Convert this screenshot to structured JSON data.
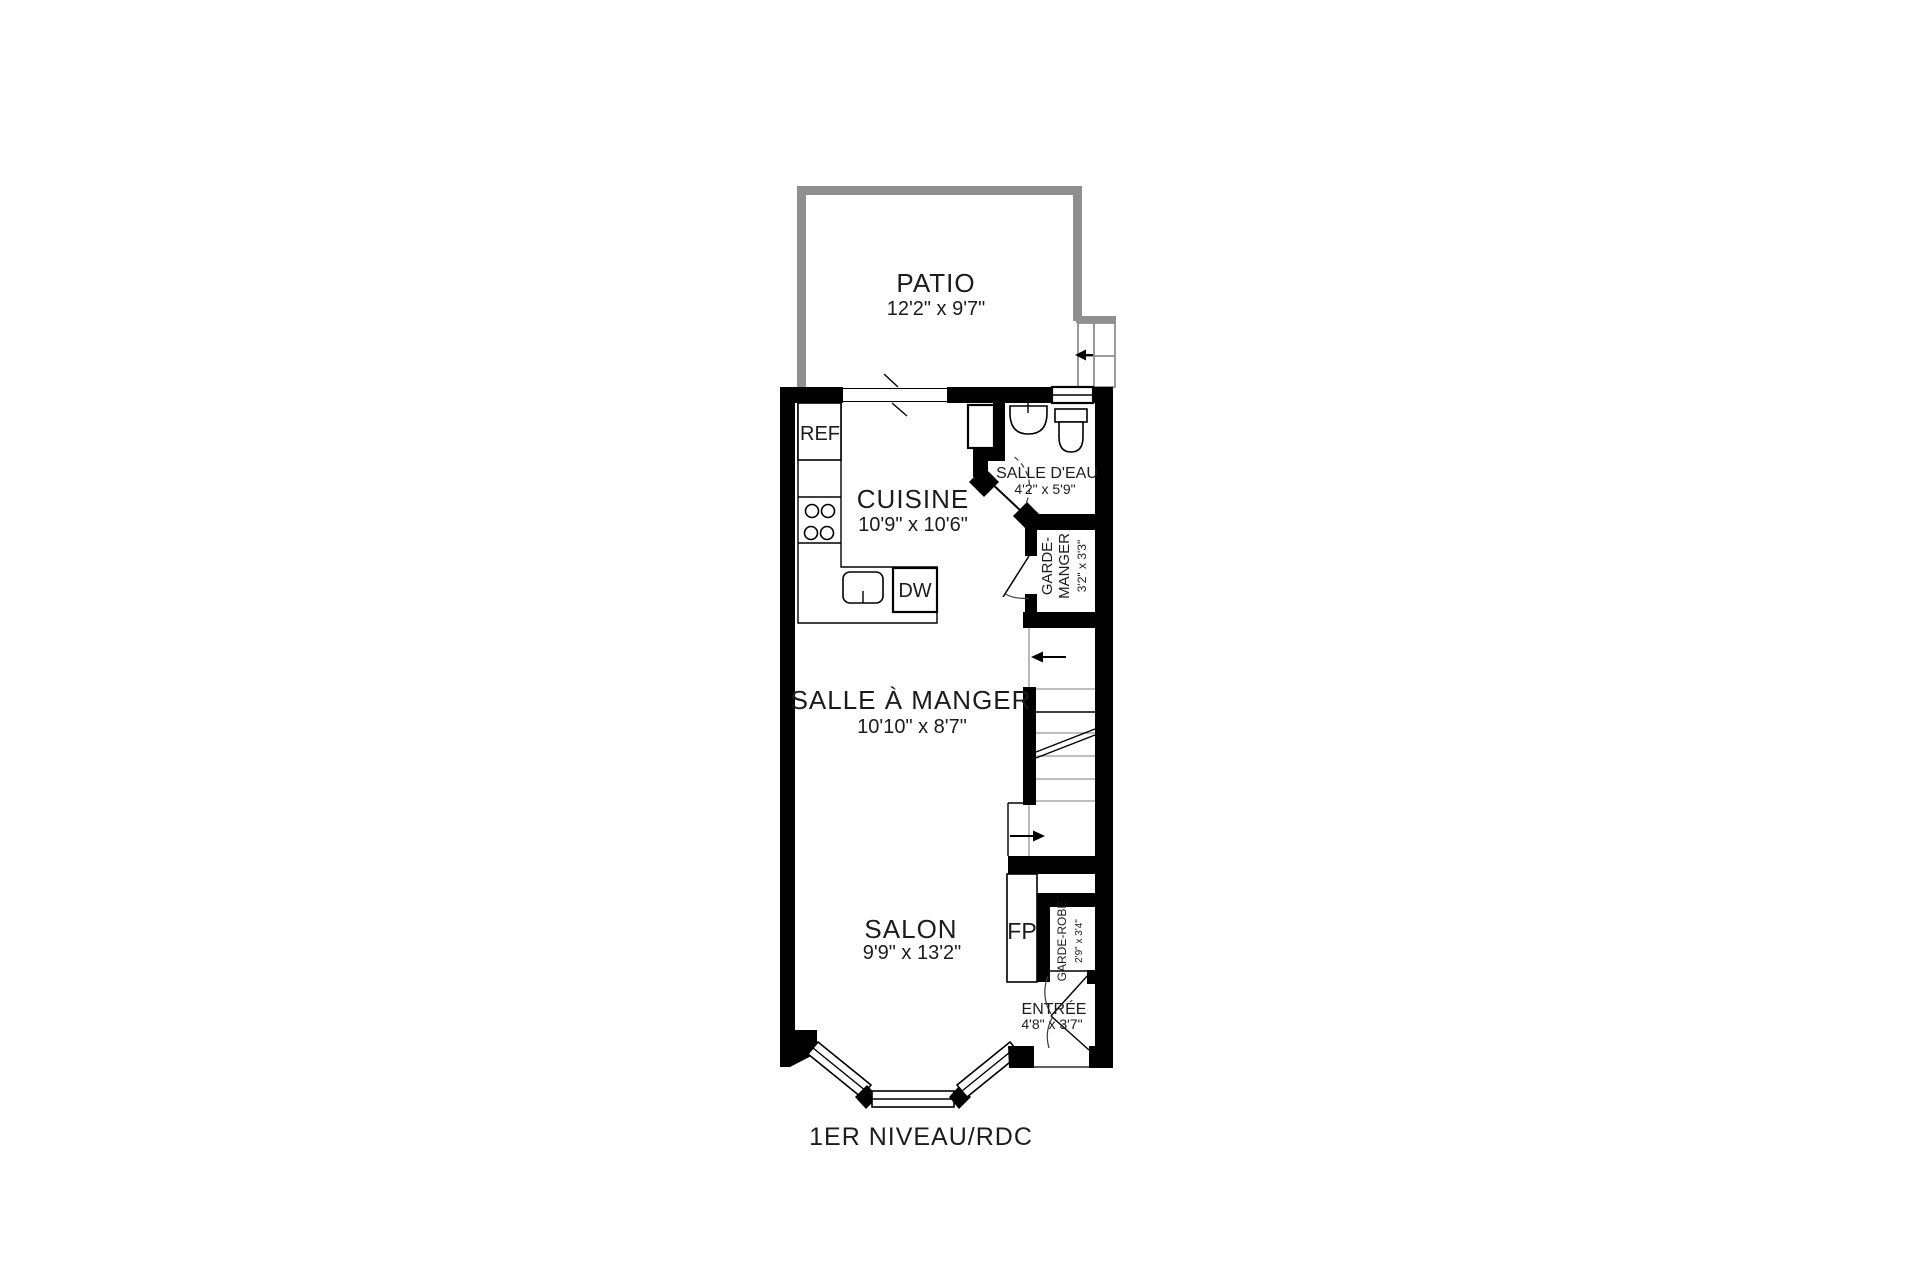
{
  "plan": {
    "title": "1ER NIVEAU/RDC",
    "rooms": {
      "patio": {
        "name": "PATIO",
        "dims": "12'2\" x 9'7\""
      },
      "cuisine": {
        "name": "CUISINE",
        "dims": "10'9\" x 10'6\""
      },
      "salle_deau": {
        "name": "SALLE D'EAU",
        "dims": "4'2\" x 5'9\""
      },
      "garde_manger": {
        "name_line1": "GARDE-",
        "name_line2": "MANGER",
        "dims": "3'2\" x 3'3\""
      },
      "salle_a_manger": {
        "name": "SALLE À MANGER",
        "dims": "10'10\" x 8'7\""
      },
      "salon": {
        "name": "SALON",
        "dims": "9'9\" x 13'2\""
      },
      "garde_robe": {
        "name": "GARDE-ROBE",
        "dims": "2'9\" x 3'4\""
      },
      "entree": {
        "name": "ENTRÉE",
        "dims": "4'8\" x 3'7\""
      }
    },
    "fixtures": {
      "refrigerator": "REF",
      "dishwasher": "DW",
      "fireplace": "FP"
    },
    "colors": {
      "wall": "#000000",
      "patio_wall": "#8f8f8f",
      "light_line": "#a8a8a8",
      "background": "#ffffff"
    }
  }
}
